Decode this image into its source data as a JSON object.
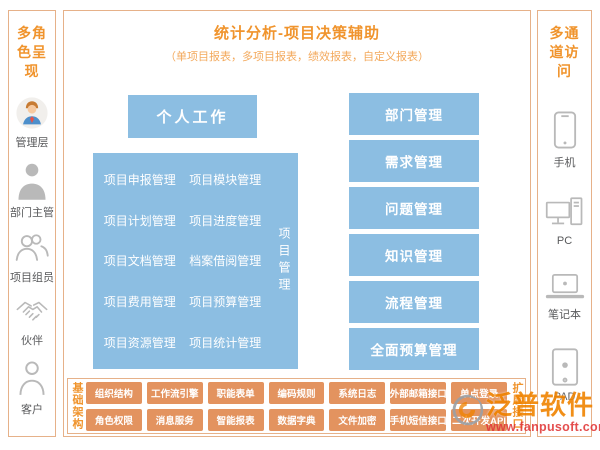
{
  "left_sidebar": {
    "title": "多角色呈现",
    "roles": [
      {
        "label": "管理层",
        "icon": "manager-avatar-icon"
      },
      {
        "label": "部门主管",
        "icon": "department-head-icon"
      },
      {
        "label": "项目组员",
        "icon": "team-members-icon"
      },
      {
        "label": "伙伴",
        "icon": "partner-handshake-icon"
      },
      {
        "label": "客户",
        "icon": "customer-icon"
      }
    ]
  },
  "header": {
    "title": "统计分析-项目决策辅助",
    "subtitle": "（单项目报表，多项目报表，绩效报表，自定义报表）"
  },
  "personal_work_label": "个人工作",
  "project_management": {
    "vertical_label": "项目管理",
    "items": [
      "项目申报管理",
      "项目模块管理",
      "项目计划管理",
      "项目进度管理",
      "项目文档管理",
      "档案借阅管理",
      "项目费用管理",
      "项目预算管理",
      "项目资源管理",
      "项目统计管理"
    ]
  },
  "right_modules": [
    "部门管理",
    "需求管理",
    "问题管理",
    "知识管理",
    "流程管理",
    "全面预算管理"
  ],
  "foundation": {
    "left_vertical_label": "基础架构",
    "right_vertical_label": "扩展接口",
    "row1": [
      "组织结构",
      "工作流引擎",
      "职能表单",
      "编码规则",
      "系统日志",
      "外部邮箱接口",
      "单点登录"
    ],
    "row2": [
      "角色权限",
      "消息服务",
      "智能报表",
      "数据字典",
      "文件加密",
      "手机短信接口",
      "二次开发API"
    ]
  },
  "right_sidebar": {
    "title": "多通道访问",
    "channels": [
      {
        "label": "手机",
        "icon": "smartphone-icon"
      },
      {
        "label": "PC",
        "icon": "desktop-pc-icon"
      },
      {
        "label": "笔记本",
        "icon": "laptop-icon"
      },
      {
        "label": "PAD",
        "icon": "tablet-icon"
      }
    ]
  },
  "watermark": {
    "brand": "泛普软件",
    "url": "www.fanpusoft.com"
  },
  "colors": {
    "accent_orange_text": "#F0942D",
    "module_blue": "#8CBEE2",
    "button_orange": "#E3935F",
    "panel_border": "#E6B189",
    "watermark_brand_orange": "#F08300",
    "watermark_red": "#E23B3B",
    "icon_gray": "#B9B9B9"
  }
}
